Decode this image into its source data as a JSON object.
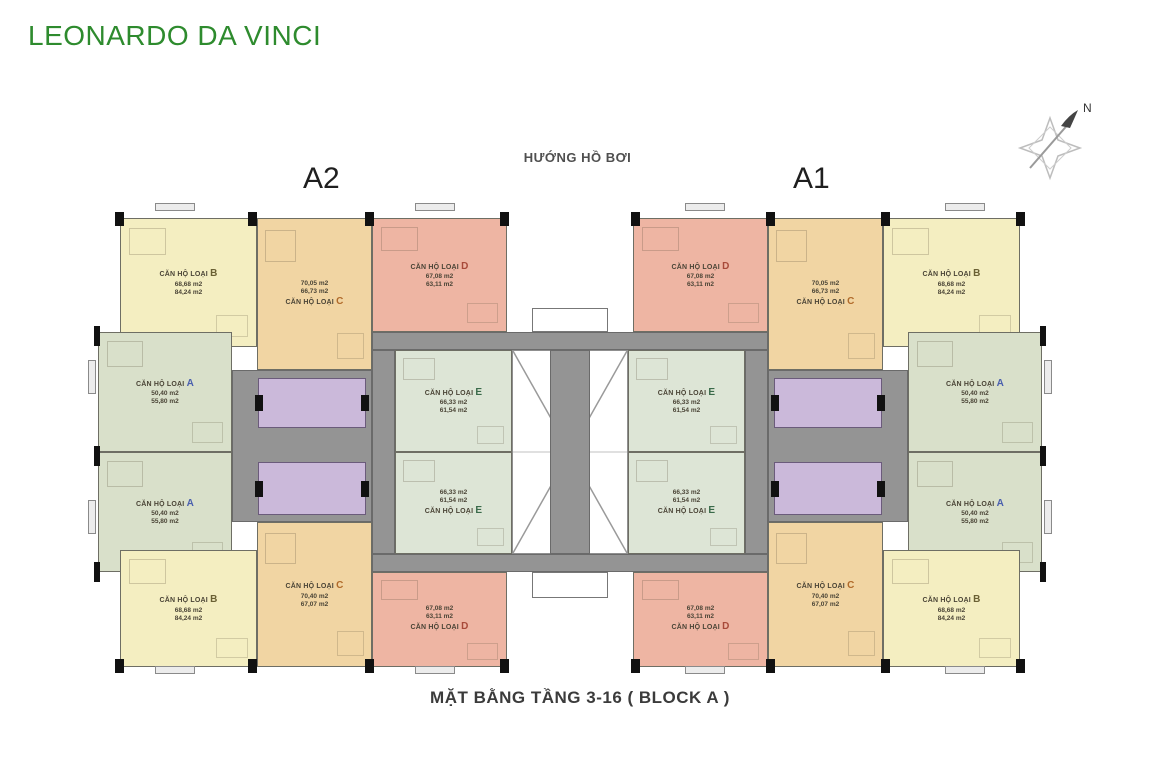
{
  "title": "LEONARDO DA VINCI",
  "header": {
    "direction_label": "HƯỚNG HỒ BƠI",
    "block_left_label": "A2",
    "block_right_label": "A1",
    "compass_label": "N"
  },
  "caption": "MẶT BẰNG TẦNG 3-16 ( BLOCK A )",
  "palette": {
    "title_green": "#2e8b2e",
    "corridor_gray": "#949494",
    "core_purple": "#cbb9da",
    "wall_dark": "#111111"
  },
  "unit_types": {
    "A": {
      "fill": "#d9e0ca",
      "letter_color": "#4a5fae"
    },
    "B": {
      "fill": "#f4eec1",
      "letter_color": "#6a6034"
    },
    "C": {
      "fill": "#f1d5a3",
      "letter_color": "#b06a2a"
    },
    "D": {
      "fill": "#eeb5a3",
      "letter_color": "#a84a3a"
    },
    "E": {
      "fill": "#dde5d6",
      "letter_color": "#3a6a4a"
    }
  },
  "units": [
    {
      "id": "a2-b-top",
      "type": "B",
      "type_label": "CĂN HỘ LOẠI",
      "type_letter": "B",
      "area1": "68,68 m2",
      "area2": "84,24 m2"
    },
    {
      "id": "a2-c-top",
      "type": "C",
      "type_label": "CĂN HỘ LOẠI",
      "type_letter": "C",
      "area1": "70,05 m2",
      "area2": "66,73 m2"
    },
    {
      "id": "a2-d-top",
      "type": "D",
      "type_label": "CĂN HỘ LOẠI",
      "type_letter": "D",
      "area1": "67,08 m2",
      "area2": "63,11 m2"
    },
    {
      "id": "a2-e-top",
      "type": "E",
      "type_label": "CĂN HỘ LOẠI",
      "type_letter": "E",
      "area1": "66,33 m2",
      "area2": "61,54 m2"
    },
    {
      "id": "a2-a-top",
      "type": "A",
      "type_label": "CĂN HỘ LOẠI",
      "type_letter": "A",
      "area1": "50,40 m2",
      "area2": "55,80 m2"
    },
    {
      "id": "a2-a-bot",
      "type": "A",
      "type_label": "CĂN HỘ LOẠI",
      "type_letter": "A",
      "area1": "50,40 m2",
      "area2": "55,80 m2"
    },
    {
      "id": "a2-e-bot",
      "type": "E",
      "type_label": "CĂN HỘ LOẠI",
      "type_letter": "E",
      "area1": "66,33 m2",
      "area2": "61,54 m2"
    },
    {
      "id": "a2-c-bot",
      "type": "C",
      "type_label": "CĂN HỘ LOẠI",
      "type_letter": "C",
      "area1": "70,40 m2",
      "area2": "67,07 m2"
    },
    {
      "id": "a2-d-bot",
      "type": "D",
      "type_label": "CĂN HỘ LOẠI",
      "type_letter": "D",
      "area1": "67,08 m2",
      "area2": "63,11 m2"
    },
    {
      "id": "a2-b-bot",
      "type": "B",
      "type_label": "CĂN HỘ LOẠI",
      "type_letter": "B",
      "area1": "68,68 m2",
      "area2": "84,24 m2"
    },
    {
      "id": "a1-b-top",
      "type": "B",
      "type_label": "CĂN HỘ LOẠI",
      "type_letter": "B",
      "area1": "68,68 m2",
      "area2": "84,24 m2"
    },
    {
      "id": "a1-c-top",
      "type": "C",
      "type_label": "CĂN HỘ LOẠI",
      "type_letter": "C",
      "area1": "70,05 m2",
      "area2": "66,73 m2"
    },
    {
      "id": "a1-d-top",
      "type": "D",
      "type_label": "CĂN HỘ LOẠI",
      "type_letter": "D",
      "area1": "67,08 m2",
      "area2": "63,11 m2"
    },
    {
      "id": "a1-e-top",
      "type": "E",
      "type_label": "CĂN HỘ LOẠI",
      "type_letter": "E",
      "area1": "66,33 m2",
      "area2": "61,54 m2"
    },
    {
      "id": "a1-a-top",
      "type": "A",
      "type_label": "CĂN HỘ LOẠI",
      "type_letter": "A",
      "area1": "50,40 m2",
      "area2": "55,80 m2"
    },
    {
      "id": "a1-a-bot",
      "type": "A",
      "type_label": "CĂN HỘ LOẠI",
      "type_letter": "A",
      "area1": "50,40 m2",
      "area2": "55,80 m2"
    },
    {
      "id": "a1-e-bot",
      "type": "E",
      "type_label": "CĂN HỘ LOẠI",
      "type_letter": "E",
      "area1": "66,33 m2",
      "area2": "61,54 m2"
    },
    {
      "id": "a1-c-bot",
      "type": "C",
      "type_label": "CĂN HỘ LOẠI",
      "type_letter": "C",
      "area1": "70,40 m2",
      "area2": "67,07 m2"
    },
    {
      "id": "a1-d-bot",
      "type": "D",
      "type_label": "CĂN HỘ LOẠI",
      "type_letter": "D",
      "area1": "67,08 m2",
      "area2": "63,11 m2"
    },
    {
      "id": "a1-b-bot",
      "type": "B",
      "type_label": "CĂN HỘ LOẠI",
      "type_letter": "B",
      "area1": "68,68 m2",
      "area2": "84,24 m2"
    }
  ]
}
